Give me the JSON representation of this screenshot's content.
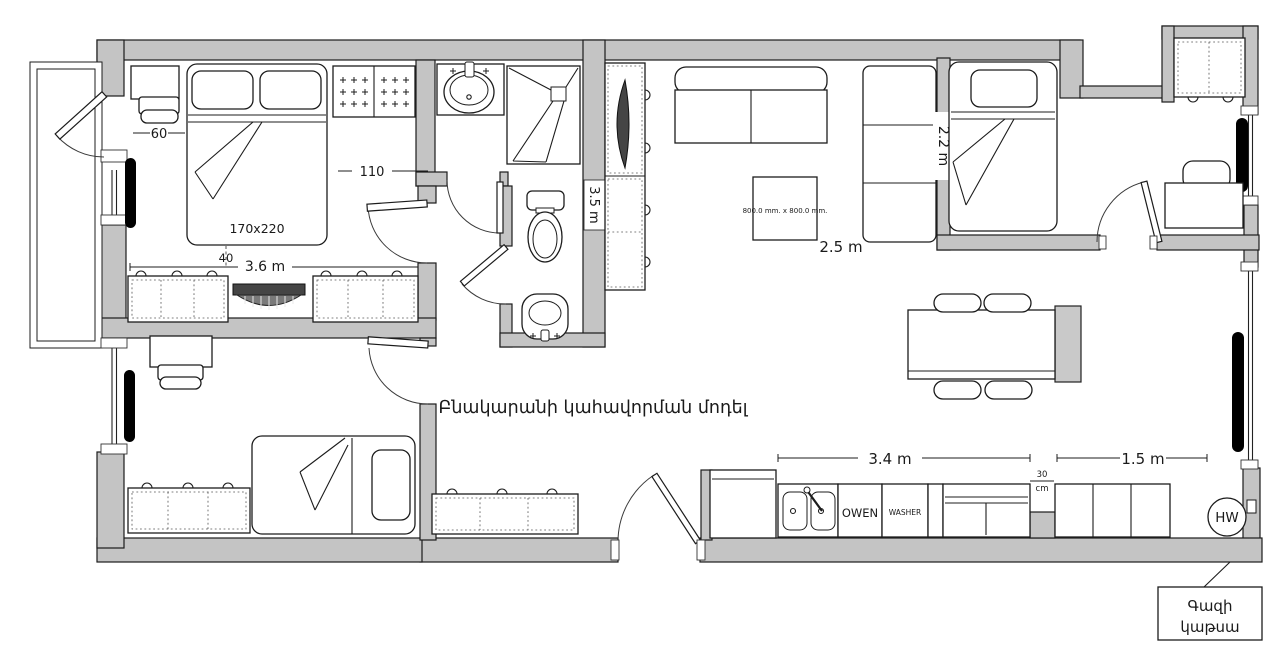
{
  "title": "Բնակարանի կահավորման մոդել",
  "dimensions": {
    "bed1_size": "170x220",
    "side_60": "60",
    "door_110": "110",
    "gap_40": "40",
    "room_width": "3.6 m",
    "hall_length": "3.5 m",
    "unit_height": "2.2 m",
    "living_gap": "2.5 m",
    "table_size": "800.0 mm. x 800.0 mm.",
    "kitchen_left": "3.4 m",
    "kitchen_right": "1.5 m",
    "kitchen_gap_value": "30",
    "kitchen_gap_unit": "cm"
  },
  "appliances": {
    "oven": "OWEN",
    "washer": "WASHER",
    "water_heater": "HW"
  },
  "callouts": {
    "boiler_line1": "Գազի",
    "boiler_line2": "կաթսա"
  },
  "colors": {
    "wall": "#c4c4c4",
    "outline": "#1c1c1c",
    "radiator": "#000000",
    "dark_accent": "#454545"
  }
}
